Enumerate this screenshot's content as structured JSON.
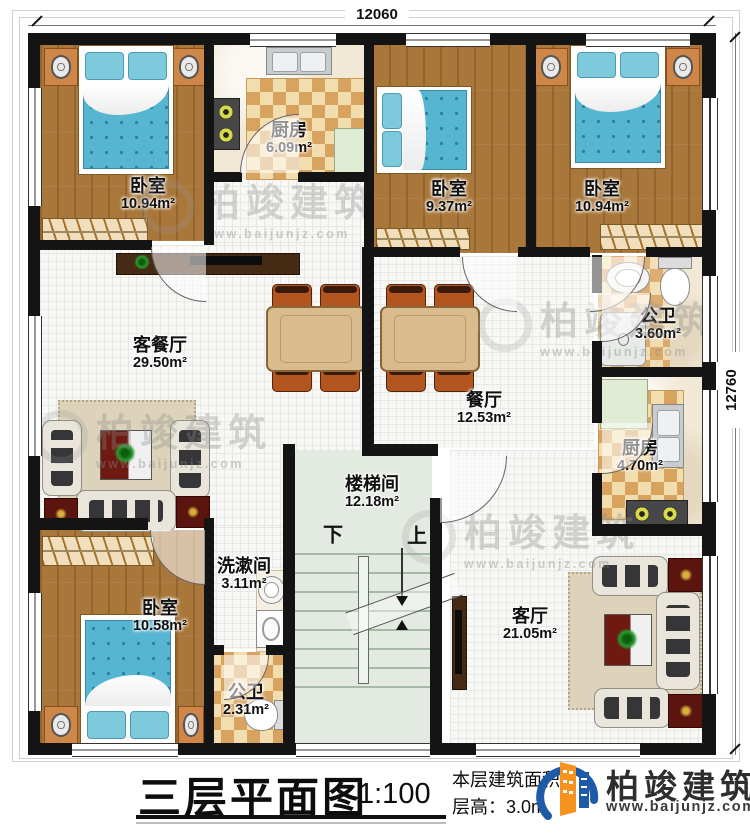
{
  "dimensions": {
    "top": "12060",
    "right": "12760"
  },
  "rooms": [
    {
      "id": "bedroom_tl",
      "name": "卧室",
      "area": "10.94m²"
    },
    {
      "id": "kitchen_top",
      "name": "厨房",
      "area": "6.09m²"
    },
    {
      "id": "bedroom_tm",
      "name": "卧室",
      "area": "9.37m²"
    },
    {
      "id": "bedroom_tr",
      "name": "卧室",
      "area": "10.94m²"
    },
    {
      "id": "bath_right",
      "name": "公卫",
      "area": "3.60m²"
    },
    {
      "id": "kitchen_right",
      "name": "厨房",
      "area": "4.70m²"
    },
    {
      "id": "living_dining",
      "name": "客餐厅",
      "area": "29.50m²"
    },
    {
      "id": "dining",
      "name": "餐厅",
      "area": "12.53m²"
    },
    {
      "id": "stairwell",
      "name": "楼梯间",
      "area": "12.18m²"
    },
    {
      "id": "washroom",
      "name": "洗漱间",
      "area": "3.11m²"
    },
    {
      "id": "bedroom_bl",
      "name": "卧室",
      "area": "10.58m²"
    },
    {
      "id": "bath_bottom",
      "name": "公卫",
      "area": "2.31m²"
    },
    {
      "id": "living",
      "name": "客厅",
      "area": "21.05m²"
    }
  ],
  "stairs": {
    "down": "下",
    "up": "上"
  },
  "title_block": {
    "title": "三层平面图",
    "scale": "1:100",
    "area_line": "本层建筑面积：",
    "height_line": "层高：3.0m"
  },
  "brand": {
    "name": "柏竣建筑",
    "url": "www.baijunjz.com",
    "orange": "#f6921e",
    "blue": "#1e5aa8"
  },
  "watermark": {
    "text": "柏竣建筑",
    "url": "www.baijunjz.com"
  }
}
